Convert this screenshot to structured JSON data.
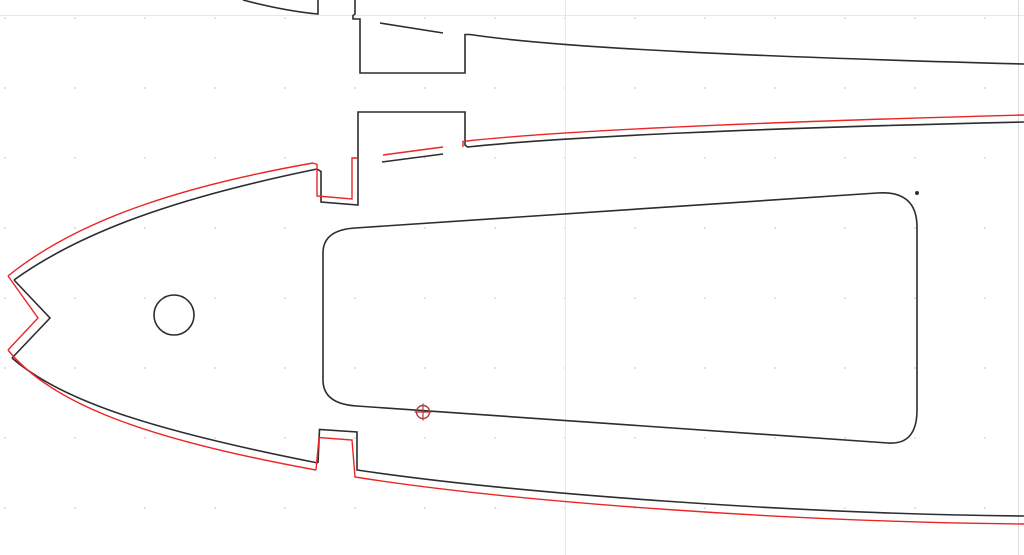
{
  "app": {
    "name": "cad-drawing-canvas"
  },
  "canvas": {
    "width": 1024,
    "height": 555,
    "background": "#ffffff"
  },
  "colors": {
    "outline": "#2d2d2d",
    "toolpath": "#ee2424",
    "marker": "#b03a3a",
    "grid_line": "#e8e8ec",
    "page_border": "#dcdce0",
    "grid_dot": "#d2d2d7"
  },
  "grid": {
    "dot_spacing": 70,
    "dot_origin": {
      "x": 5,
      "y": 18
    },
    "dot_size": 1.6,
    "major_vline_x": 565.5,
    "major_hline_y": 15.5,
    "page_border_x": 1018.5
  },
  "geometry": {
    "outline_stroke_width": 1.6,
    "toolpath_stroke_width": 1.4,
    "outline_paths": [
      {
        "name": "upper-part-leading-edge",
        "d": "M 243,0 Q 285,11 318,14 L 318,0"
      },
      {
        "name": "upper-part-notch-and-tab",
        "d": "M 355,0 L 355,14 L 353,15.5 L 353,19 L 360,19 L 360,73 L 465,73 L 465,34.5 L 470,34.5 C 560,48 760,57 1024,64"
      },
      {
        "name": "upper-part-surface-through-tab",
        "d": "M 380,23 L 443,33"
      },
      {
        "name": "rib-top-surface-left",
        "d": "M 14,280 C 90,225 200,193 317,169"
      },
      {
        "name": "rib-nose-v-notch",
        "d": "M 14,280 L 50,318 L 12,358"
      },
      {
        "name": "rib-bottom-surface-left",
        "d": "M 12,358 C 60,400 150,430 318,463"
      },
      {
        "name": "rib-top-notch-and-spar-tab",
        "d": "M 317,169 L 321,171.5 L 321,202 L 358,205 L 358,112 L 465,112 L 465,145 L 467.5,147 C 560,137 760,128 1024,122"
      },
      {
        "name": "rib-surface-through-tab",
        "d": "M 382,162 L 443,154"
      },
      {
        "name": "rib-bottom-notch-and-tail",
        "d": "M 318,463 L 319.5,429.5 L 357,432 L 357,470 C 520,494 800,514 1024,516"
      },
      {
        "name": "rib-lightening-hole",
        "d": "M 355,228 L 877,193 Q 917,190 917,227 L 917,410 Q 917,445 888,443 L 357,406 Q 323,404 323,380 L 323,253 Q 323,230 355,228 Z"
      }
    ],
    "toolpath_paths": [
      {
        "name": "toolpath-top-surface-left",
        "d": "M 8,276 C 82,216 194,184 313,163"
      },
      {
        "name": "toolpath-nose-v-notch",
        "d": "M 8,276 L 38,318 L 8,350"
      },
      {
        "name": "toolpath-bottom-surface-left",
        "d": "M 8,350 C 50,402 140,438 316,470"
      },
      {
        "name": "toolpath-top-notch",
        "d": "M 313,163 L 317,164.5 L 317,196 L 352,199 L 352,158 L 358,158"
      },
      {
        "name": "toolpath-surface-through-tab",
        "d": "M 383,155 L 443,147"
      },
      {
        "name": "toolpath-top-surface-right",
        "d": "M 463,147 L 463,141.5 L 467,141 C 560,131 760,122 1024,115"
      },
      {
        "name": "toolpath-bottom-notch-and-tail",
        "d": "M 316,470 L 319,437.5 L 352,440 L 355,477 C 520,503 800,522 1024,524"
      }
    ],
    "circles": [
      {
        "name": "rib-wire-hole",
        "cx": 174,
        "cy": 315,
        "r": 20
      }
    ],
    "points": [
      {
        "name": "vertex-node-dot",
        "cx": 917,
        "cy": 193,
        "r": 2
      }
    ],
    "marker": {
      "name": "snap-origin-marker",
      "cx": 423,
      "cy": 412,
      "r": 6.5,
      "tick": 8.5
    }
  }
}
